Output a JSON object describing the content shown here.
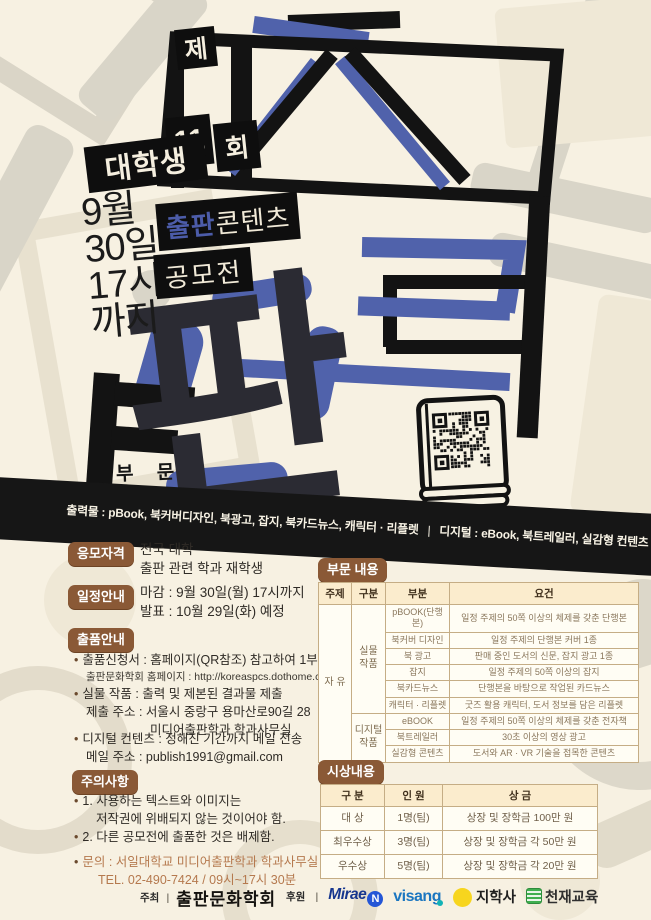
{
  "colors": {
    "accent_blue": "#5062ab",
    "ink": "#141414",
    "badge_brown": "#8a5936",
    "cream": "#f7f1e2",
    "table_header_bg": "#fbeccd",
    "contact_brown": "#b5794e"
  },
  "hero": {
    "round_prefix": "제",
    "round_number": "11",
    "round_suffix": "회",
    "audience": "대학생",
    "deadline": [
      "9월",
      "30일",
      "17시",
      "까지"
    ],
    "title_main": "출판",
    "title_tail": "콘텐츠",
    "title_sub": "공모전",
    "glyph": "판",
    "section_word": "부 문",
    "band_print": "출력물 : pBook, 북커버디자인, 북광고, 잡지, 북카드뉴스, 캐릭터 · 리플렛",
    "band_sep": "|",
    "band_digital": "디지털 : eBook, 북트레일러, 실감형 컨텐츠"
  },
  "info": {
    "eligibility": {
      "badge": "응모자격",
      "line1": "전국 대학",
      "line2": "출판 관련 학과 재학생"
    },
    "schedule": {
      "badge": "일정안내",
      "line1": "마감 : 9월 30일(월) 17시까지",
      "line2": "발표 : 10월 29일(화) 예정"
    },
    "submission": {
      "badge": "출품안내",
      "item1_line1": "출품신청서 : 홈페이지(QR참조) 참고하여 1부 제출",
      "item1_line2": "출판문화학회 홈페이지 : http://koreaspcs.dothome.co.kr/",
      "item2_line1": "실물 작품 : 출력 및 제본된 결과물 제출",
      "item2_line2": "제출 주소 : 서울시 중랑구 용마산로90길 28",
      "item2_line3": "미디어출판학과 학과사무실",
      "item3_line1": "디지털 컨텐츠 : 정해진 기간까지 메일 전송",
      "item3_line2": "메일 주소 : publish1991@gmail.com"
    },
    "notice": {
      "badge": "주의사항",
      "item1_line1": "1. 사용하는 텍스트와 이미지는",
      "item1_line2": "저작권에 위배되지 않는 것이어야 함.",
      "item2": "2. 다른 공모전에 출품한 것은 배제함.",
      "contact_line1": "문의 : 서일대학교 미디어출판학과 학과사무실",
      "contact_line2": "TEL. 02-490-7424 / 09시~17시 30분"
    }
  },
  "sections_table": {
    "badge": "부문 내용",
    "headers": [
      "주제",
      "구분",
      "부분",
      "요건"
    ],
    "theme": "자 유",
    "group_physical_line1": "실물",
    "group_physical_line2": "작품",
    "group_digital_line1": "디지털",
    "group_digital_line2": "작품",
    "rows": [
      {
        "part": "pBOOK(단행본)",
        "req": "일정 주제의 50쪽 이상의 체제를 갖춘 단행본"
      },
      {
        "part": "북커버 디자인",
        "req": "일정 주제의 단행본 커버 1종"
      },
      {
        "part": "북 광고",
        "req": "판매 중인 도서의 신문, 잡지 광고 1종"
      },
      {
        "part": "잡지",
        "req": "일정 주제의 50쪽 이상의 잡지"
      },
      {
        "part": "북카드뉴스",
        "req": "단행본을 바탕으로 작업된 카드뉴스"
      },
      {
        "part": "캐릭터 · 리플렛",
        "req": "굿즈 활용 캐릭터, 도서 정보를 담은 리플렛"
      },
      {
        "part": "eBOOK",
        "req": "일정 주제의 50쪽 이상의 체제를 갖춘 전자책"
      },
      {
        "part": "북트레일러",
        "req": "30초 이상의 영상 광고"
      },
      {
        "part": "실감형 콘텐츠",
        "req": "도서와 AR · VR 기술을 접목한 콘텐츠"
      }
    ]
  },
  "awards_table": {
    "badge": "시상내용",
    "headers": [
      "구 분",
      "인 원",
      "상 금"
    ],
    "rows": [
      {
        "rank": "대 상",
        "count": "1명(팀)",
        "prize": "상장 및 장학금 100만 원"
      },
      {
        "rank": "최우수상",
        "count": "3명(팀)",
        "prize": "상장 및 장학금 각 50만 원"
      },
      {
        "rank": "우수상",
        "count": "5명(팀)",
        "prize": "상장 및 장학금 각 20만 원"
      }
    ]
  },
  "footer": {
    "host_label": "주최",
    "sep": "|",
    "host_name": "출판문화학회",
    "sponsor_label": "후원",
    "mirae_text": "Mirae",
    "mirae_n": "N",
    "visang_text": "visang",
    "jihak_text": "지학사",
    "chunjae_text": "천재교육"
  }
}
